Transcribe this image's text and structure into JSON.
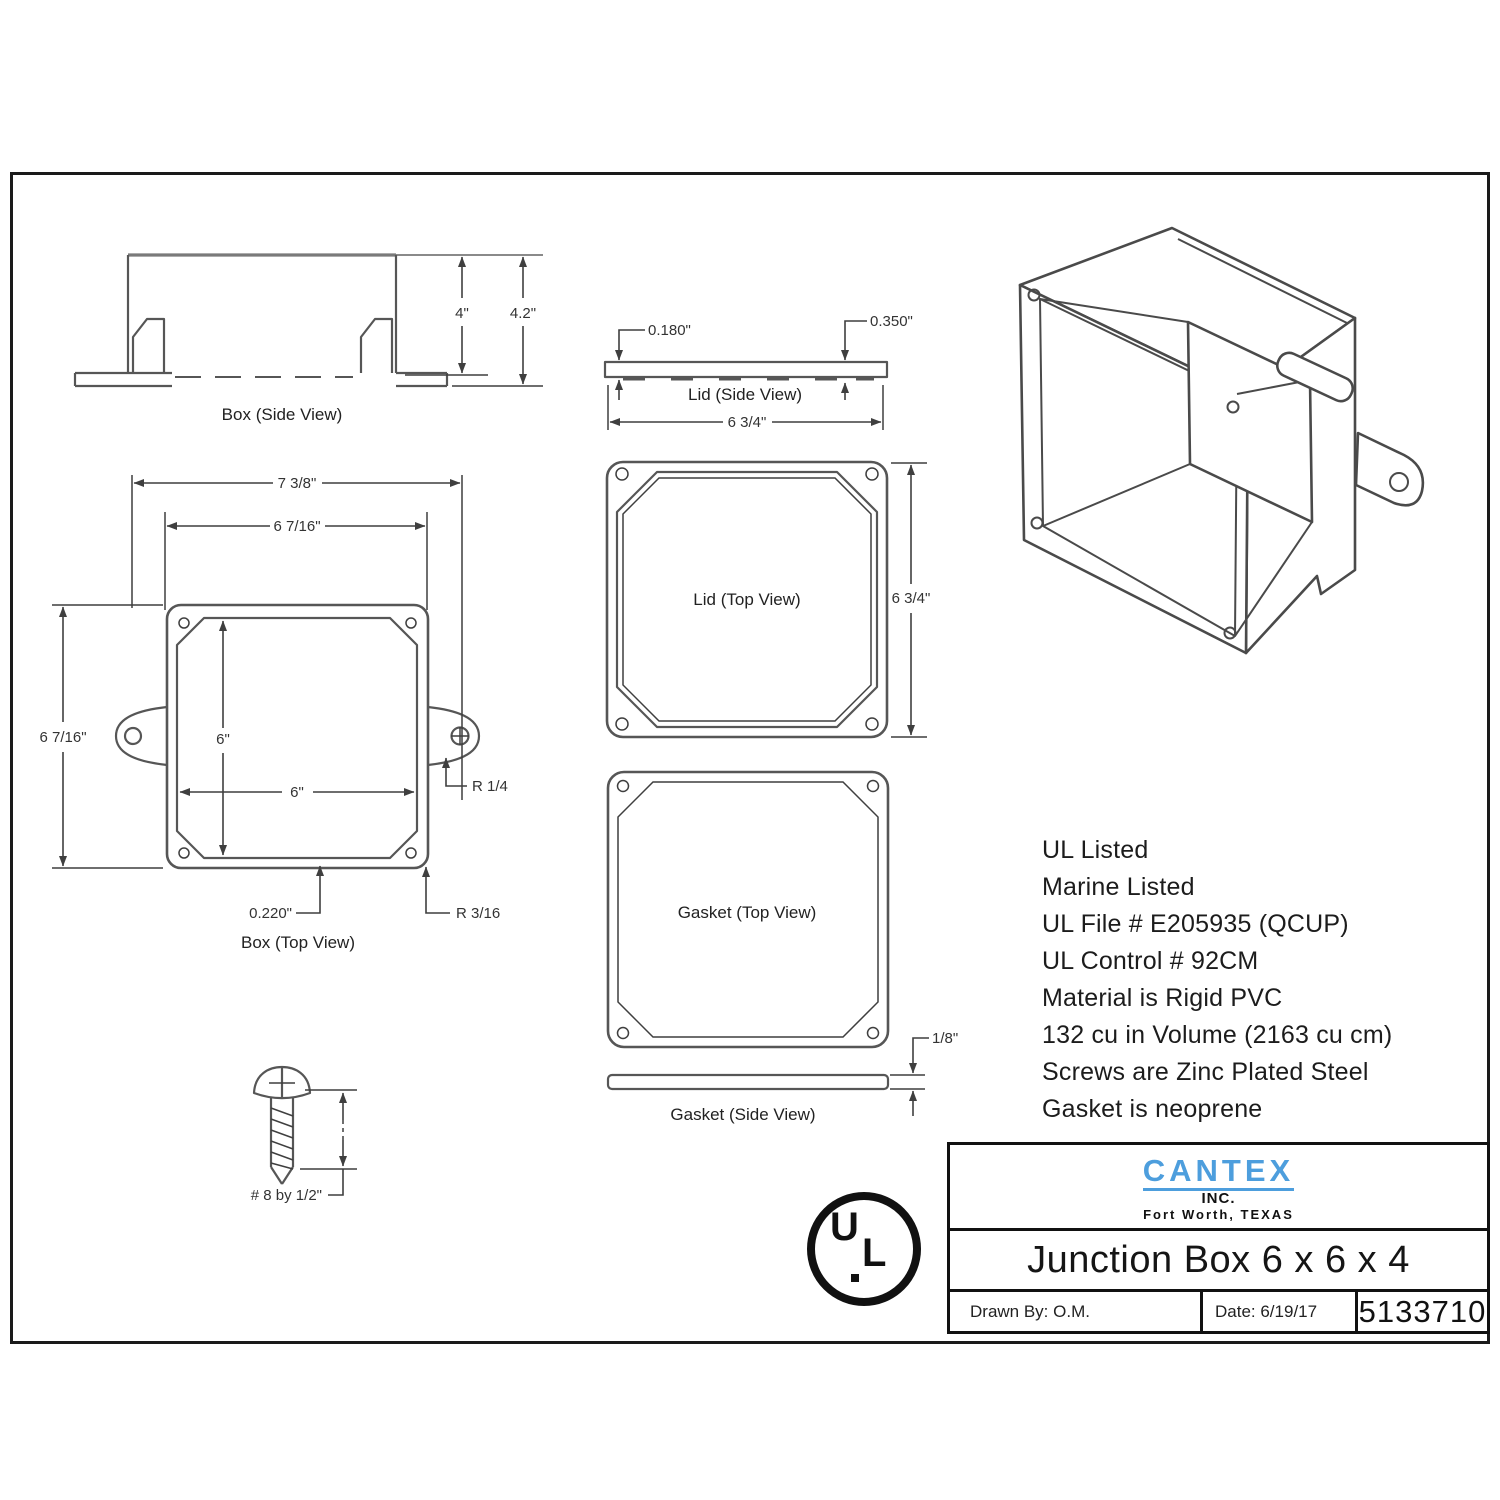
{
  "views": {
    "box_side": {
      "caption": "Box (Side View)",
      "dim_inner_height": "4\"",
      "dim_overall_height": "4.2\""
    },
    "box_top": {
      "caption": "Box (Top View)",
      "dim_overall_width": "7 3/8\"",
      "dim_flange_width": "6 7/16\"",
      "dim_flange_height": "6 7/16\"",
      "dim_inside_height": "6\"",
      "dim_inside_width": "6\"",
      "dim_wall_thickness": "0.220\"",
      "dim_ear_radius": "R 1/4",
      "dim_corner_radius": "R 3/16"
    },
    "lid_side": {
      "caption": "Lid (Side View)",
      "dim_thickness": "0.180\"",
      "dim_total_thickness": "0.350\"",
      "dim_width": "6 3/4\""
    },
    "lid_top": {
      "caption": "Lid (Top View)",
      "dim_height": "6 3/4\""
    },
    "gasket_top": {
      "caption": "Gasket (Top View)"
    },
    "gasket_side": {
      "caption": "Gasket (Side View)",
      "dim_thickness": "1/8\""
    },
    "screw": {
      "label": "# 8 by  1/2\""
    }
  },
  "specs": [
    "UL Listed",
    "Marine Listed",
    "UL File # E205935 (QCUP)",
    "UL Control # 92CM",
    "Material is Rigid PVC",
    "132 cu in Volume (2163 cu cm)",
    "Screws are Zinc Plated Steel",
    "Gasket is neoprene"
  ],
  "ul_mark": {
    "letter_u": "U",
    "letter_l": "L"
  },
  "title_block": {
    "brand": "CANTEX",
    "brand_sub": "INC.",
    "brand_city": "Fort Worth, TEXAS",
    "product": "Junction Box 6 x 6 x 4",
    "drawn_by": "Drawn By: O.M.",
    "date": "Date: 6/19/17",
    "part_number": "5133710"
  },
  "colors": {
    "brand_blue": "#4d9edd",
    "line_gray": "#565656"
  }
}
